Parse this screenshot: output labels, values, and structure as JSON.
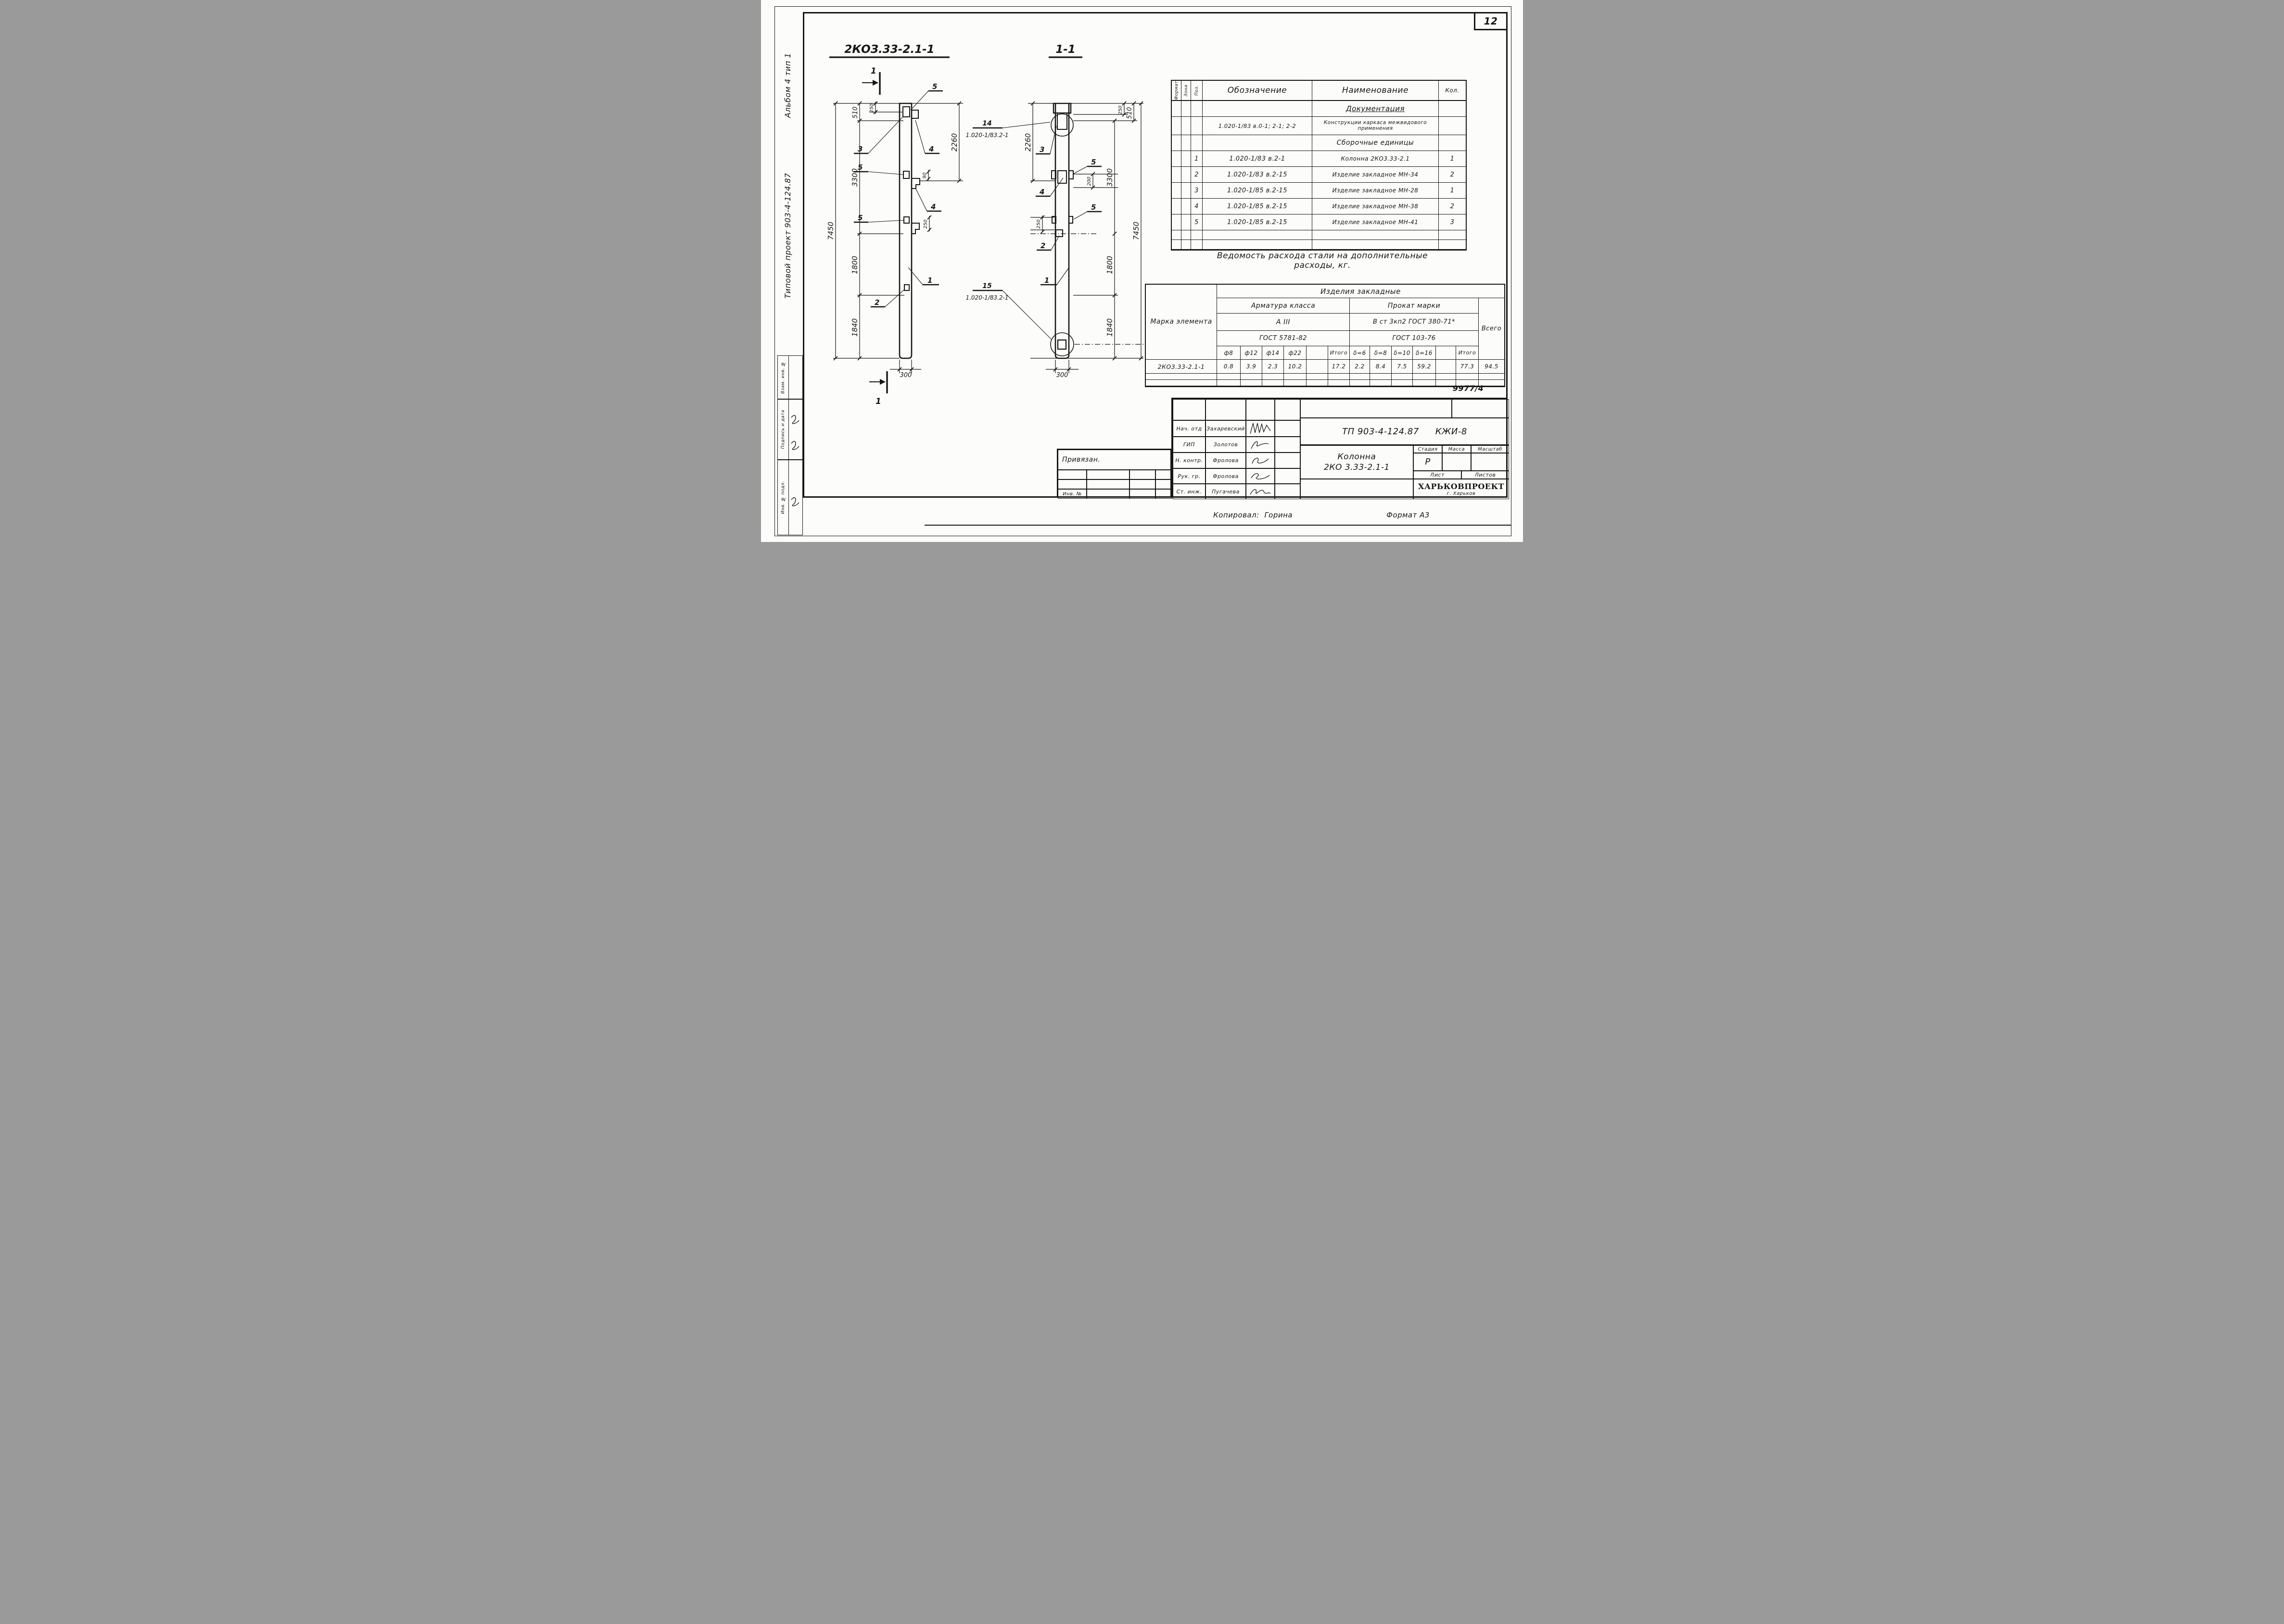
{
  "page": {
    "number": "12",
    "doc_number": "9977/4",
    "copied_by_label": "Копировал:",
    "copied_by_name": "Горина",
    "format": "Формат А3"
  },
  "margin": {
    "album": "Альбом 4 тип 1",
    "project": "Типовой проект 903-4-124.87",
    "boxes": [
      "Взам. инв. №",
      "Подпись и дата",
      "Инв. № подл."
    ]
  },
  "drawings": {
    "ref_label": "1.020-1/83.2-1",
    "left_title": "2КОЗ.33-2.1-1",
    "right_title": "1-1",
    "dims": {
      "d90": "90",
      "d200": "200",
      "d250": "250",
      "d300": "300",
      "d510": "510",
      "d1800": "1800",
      "d1840": "1840",
      "d2260": "2260",
      "d3300": "3300",
      "d7450": "7450"
    },
    "callouts": {
      "n1": "1",
      "n2": "2",
      "n3": "3",
      "n4": "4",
      "n5": "5",
      "n14": "14",
      "n15": "15"
    }
  },
  "spec_table": {
    "headers": {
      "format": "Формат",
      "zone": "Зона",
      "pos": "Поз.",
      "designation": "Обозначение",
      "name": "Наименование",
      "qty": "Кол."
    },
    "rows": [
      {
        "pos": "",
        "des": "",
        "name": "Документация",
        "qty": ""
      },
      {
        "pos": "",
        "des": "1.020-1/83 в.0-1; 2-1; 2-2",
        "name": "Конструкции каркаса межвидового применения",
        "qty": ""
      },
      {
        "pos": "",
        "des": "",
        "name": "Сборочные единицы",
        "qty": ""
      },
      {
        "pos": "1",
        "des": "1.020-1/83 в.2-1",
        "name": "Колонна 2КО3.33-2.1",
        "qty": "1"
      },
      {
        "pos": "2",
        "des": "1.020-1/83 в.2-15",
        "name": "Изделие закладное МН-34",
        "qty": "2"
      },
      {
        "pos": "3",
        "des": "1.020-1/85 в.2-15",
        "name": "Изделие закладное МН-28",
        "qty": "1"
      },
      {
        "pos": "4",
        "des": "1.020-1/85 в.2-15",
        "name": "Изделие закладное МН-38",
        "qty": "2"
      },
      {
        "pos": "5",
        "des": "1.020-1/85 в.2-15",
        "name": "Изделие закладное МН-41",
        "qty": "3"
      },
      {
        "pos": "",
        "des": "",
        "name": "",
        "qty": ""
      },
      {
        "pos": "",
        "des": "",
        "name": "",
        "qty": ""
      }
    ]
  },
  "steel_caption_line1": "Ведомость расхода стали на дополнительные",
  "steel_caption_line2": "расходы, кг.",
  "steel_table": {
    "mark_header": "Марка элемента",
    "span_header": "Изделия закладные",
    "rebar_group": "Арматура класса",
    "rebar_class": "А III",
    "rebar_gost": "ГОСТ 5781-82",
    "roll_group": "Прокат марки",
    "roll_class": "В ст 3кп2 ГОСТ 380-71*",
    "roll_gost": "ГОСТ 103-76",
    "total_header": "Всего",
    "rebar_cols": [
      "ф8",
      "ф12",
      "ф14",
      "ф22",
      "",
      "Итого"
    ],
    "roll_cols": [
      "δ=6",
      "δ=8",
      "δ=10",
      "δ=16",
      "",
      "Итого"
    ],
    "row": {
      "mark": "2КО3.33-2.1-1",
      "rebar_vals": [
        "0.8",
        "3.9",
        "2.3",
        "10.2",
        "",
        "17.2"
      ],
      "roll_vals": [
        "2.2",
        "8.4",
        "7.5",
        "59.2",
        "",
        "77.3"
      ],
      "total": "94.5"
    }
  },
  "title_block": {
    "sign_rows": [
      {
        "role": "Нач. отд",
        "name": "Захаревский"
      },
      {
        "role": "ГИП",
        "name": "Золотов"
      },
      {
        "role": "Н. контр.",
        "name": "Фролова"
      },
      {
        "role": "Рук. гр.",
        "name": "Фролова"
      },
      {
        "role": "Ст. инж.",
        "name": "Пугачева"
      }
    ],
    "doc": "ТП 903-4-124.87",
    "code": "КЖИ-8",
    "object_line1": "Колонна",
    "object_line2": "2КО 3.33-2.1-1",
    "stage_label": "Стадия",
    "mass_label": "Масса",
    "scale_label": "Масштаб",
    "stage_value": "Р",
    "sheet_label": "Лист",
    "sheets_label": "Листов",
    "org_name": "ХАРЬКОВПРОЕКТ",
    "org_city": "г. Харьков",
    "attached": "Привязан.",
    "inv_label": "Инв. №"
  }
}
